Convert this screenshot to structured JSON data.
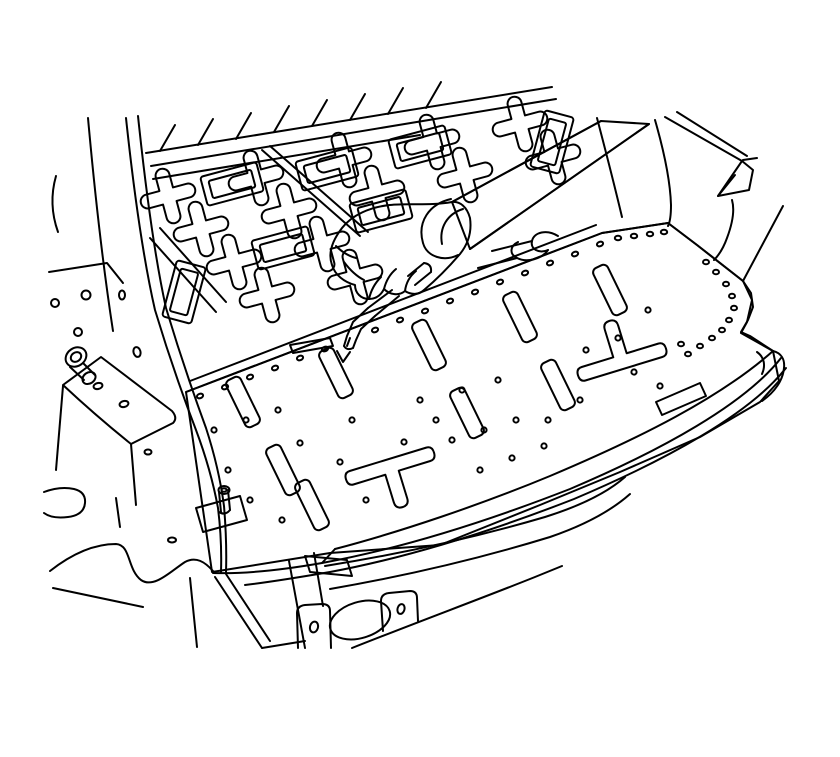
{
  "figure": {
    "alt": "Black-and-white service-manual line illustration of a vehicle rear cargo floor area seen in perspective. A hand holding a marking tool points to the weld flange seam between the intermediate floor panel and the rear floor panel; a small arrow marks the point on the seam. The panels show plug-weld holes, slotted cutouts, a mounting stud on a small plate, the left wheelhouse bracket with a stud and holes, the right quarter-panel flange with a folded tab, and the rear bumper/valance structure below the curved panel edge.",
    "background_color": "#ffffff",
    "line_color": "#000000"
  },
  "parts": {
    "left_pillar": "left body pillar",
    "left_bracket": "left wheelhouse bracket with stud and holes",
    "upper_floor": "intermediate floor panel with slotted rib pattern",
    "right_quarter": "right quarter panel flange with folded tab",
    "hand_tool": "hand holding marking tool",
    "pointer_arrow": "arrow at marked seam point",
    "rear_floor": "rear floor panel with plug-weld holes, slots and stud plate",
    "bumper_area": "rear bumper bar and valance brackets with oval opening"
  }
}
